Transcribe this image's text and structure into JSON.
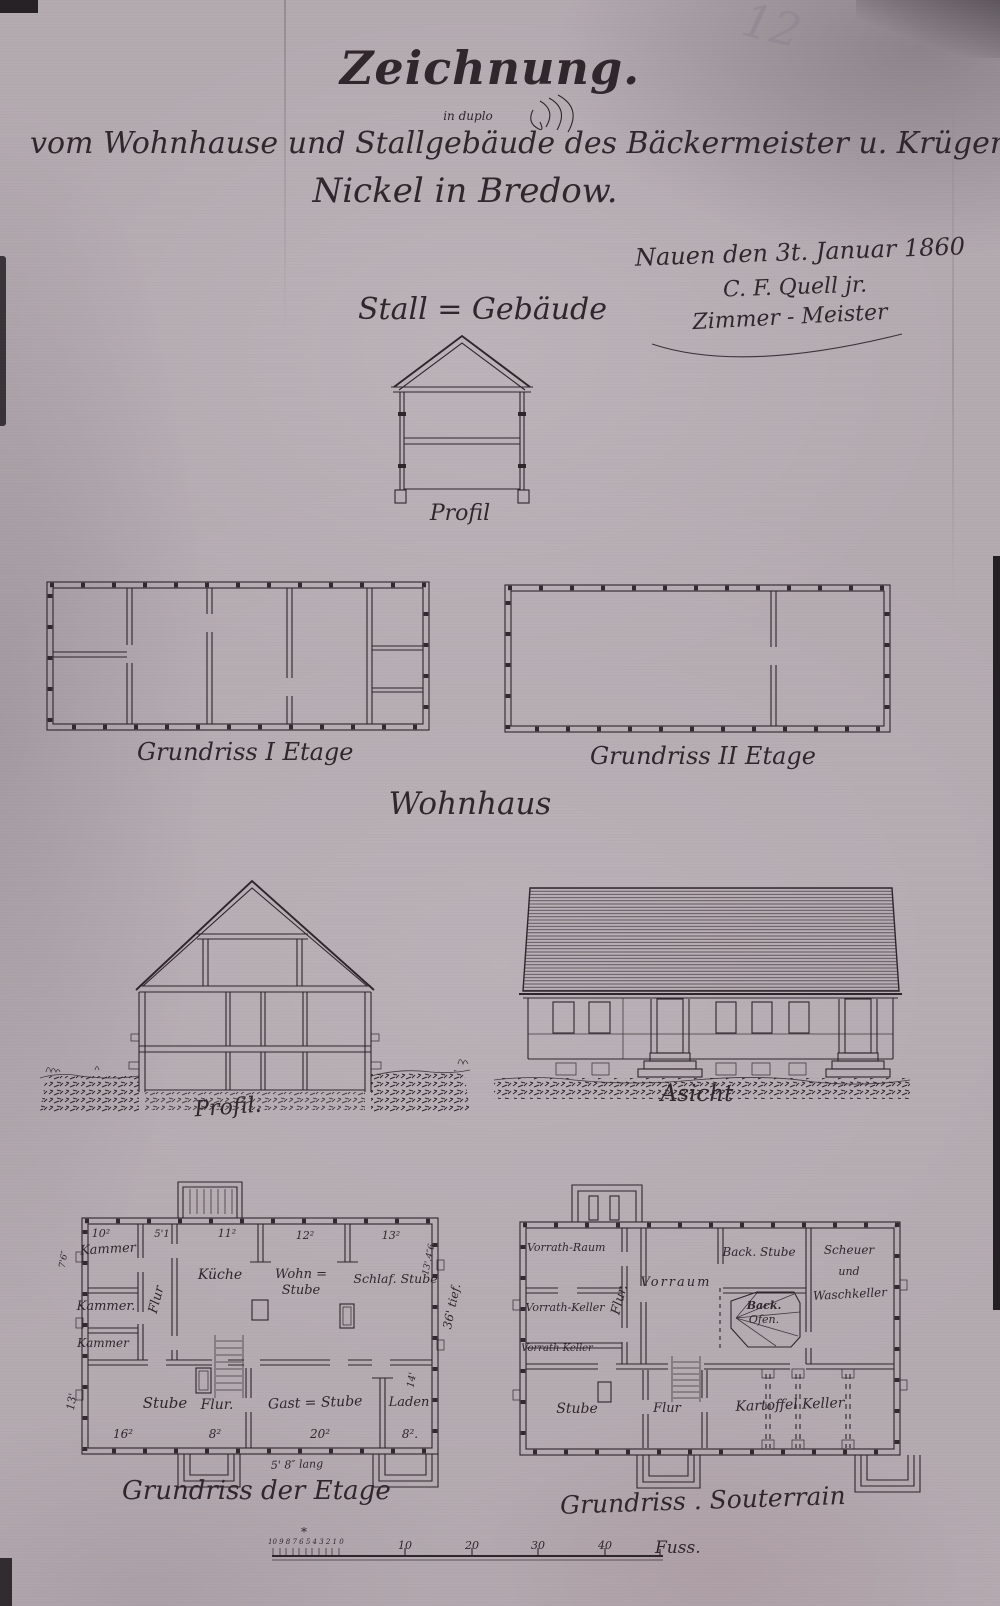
{
  "palette": {
    "paper": "#b4abb1",
    "ink": "#30272d",
    "pencil": "#8f8791"
  },
  "corner_note": {
    "pencil_number": "12"
  },
  "title": {
    "main": "Zeichnung.",
    "note": "in duplo",
    "line1": "vom Wohnhause und Stallgebäude des Bäckermeister u. Krüger",
    "line2": "Nickel in Bredow."
  },
  "signature": {
    "place_date": "Nauen den 3t. Januar 1860",
    "name": "C. F. Quell jr.",
    "role": "Zimmer - Meister"
  },
  "stall": {
    "heading": "Stall = Gebäude",
    "profil_label": "Profil",
    "plan_first_label": "Grundriss I Etage",
    "plan_second_label": "Grundriss II Etage"
  },
  "house": {
    "heading": "Wohnhaus",
    "profil_label": "Profil.",
    "elevation_label": "Asicht"
  },
  "etage": {
    "label": "Grundriss der Etage",
    "rooms": {
      "kammer1": "Kammer",
      "kammer2": "Kammer.",
      "kammer3": "Kammer",
      "flur_vertical": "Flur",
      "kueche": "Küche",
      "wohnstube_line1": "Wohn =",
      "wohnstube_line2": "Stube",
      "schlafstube": "Schlaf. Stube",
      "stube": "Stube",
      "flur_bottom": "Flur.",
      "gaststube": "Gast = Stube",
      "laden": "Laden"
    },
    "dims": {
      "top_kammer": "10²",
      "top_flur": "5'1",
      "top_kueche": "11²",
      "top_wohnstube": "12²",
      "top_schlafstube": "13²",
      "right_inner": "13'.4″6",
      "right_depth": "36' tief.",
      "right_laden": "14'",
      "left_stube": "13'",
      "left_kammer": "7'6″",
      "bottom_stube": "16²",
      "bottom_flur": "8²",
      "bottom_gaststube": "20²",
      "bottom_laden": "8².",
      "porch": "5' 8″ lang"
    }
  },
  "souterrain": {
    "label": "Grundriss . Souterrain",
    "rooms": {
      "vorrath_raum": "Vorrath-Raum",
      "vorrath_keller": "Vorrath-Keller",
      "vorrath_keller2": "Vorrath Keller",
      "flur_vertical": "Flur.",
      "vorraum": "Vorraum",
      "backstube": "Back. Stube",
      "backofen_line1": "Back.",
      "backofen_line2": "Ofen.",
      "waschkeller_line1": "Scheuer",
      "waschkeller_line2": "und",
      "waschkeller_line3": "Waschkeller",
      "stube": "Stube",
      "flur_bottom": "Flur",
      "kartoffel_keller": "Kartoffel Keller"
    }
  },
  "scale_bar": {
    "minor_numbers": "10 9 8 7 6 5 4 3 2 1 0",
    "star": "*",
    "major_ticks": [
      "10",
      "20",
      "30",
      "40"
    ],
    "unit": "Fuss."
  }
}
